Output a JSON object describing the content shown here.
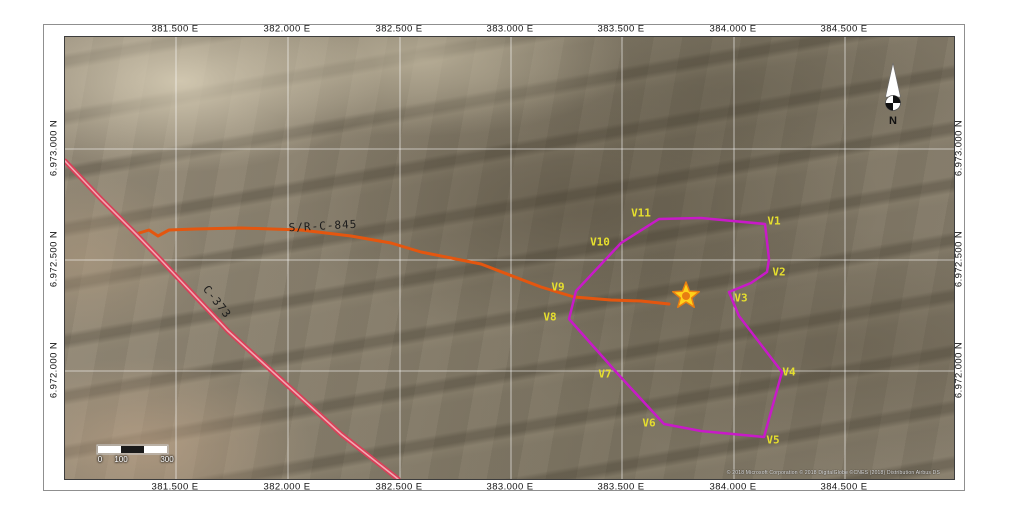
{
  "axis": {
    "top": [
      {
        "text": "381.500 E",
        "x": 175
      },
      {
        "text": "382.000 E",
        "x": 287
      },
      {
        "text": "382.500 E",
        "x": 399
      },
      {
        "text": "383.000 E",
        "x": 510
      },
      {
        "text": "383.500 E",
        "x": 621
      },
      {
        "text": "384.000 E",
        "x": 733
      },
      {
        "text": "384.500 E",
        "x": 844
      }
    ],
    "bottom": [
      {
        "text": "381.500 E",
        "x": 175
      },
      {
        "text": "382.000 E",
        "x": 287
      },
      {
        "text": "382.500 E",
        "x": 399
      },
      {
        "text": "383.000 E",
        "x": 510
      },
      {
        "text": "383.500 E",
        "x": 621
      },
      {
        "text": "384.000 E",
        "x": 733
      },
      {
        "text": "384.500 E",
        "x": 844
      }
    ],
    "left": [
      {
        "text": "6.973.000 N",
        "y": 148
      },
      {
        "text": "6.972.500 N",
        "y": 259
      },
      {
        "text": "6.972.000 N",
        "y": 370
      }
    ],
    "right": [
      {
        "text": "6.973.000 N",
        "y": 148
      },
      {
        "text": "6.972.500 N",
        "y": 259
      },
      {
        "text": "6.972.000 N",
        "y": 370
      }
    ]
  },
  "grid": {
    "vertical_x": [
      111,
      223,
      335,
      446,
      557,
      669,
      780
    ],
    "horizontal_y": [
      112,
      223,
      334
    ]
  },
  "roads": [
    {
      "name": "S/R-C-845",
      "color": "#e4560f",
      "width": 3,
      "points": [
        [
          71,
          197
        ],
        [
          84,
          193
        ],
        [
          93,
          199
        ],
        [
          104,
          193
        ],
        [
          130,
          192
        ],
        [
          176,
          191
        ],
        [
          236,
          193
        ],
        [
          286,
          199
        ],
        [
          326,
          206
        ],
        [
          356,
          215
        ],
        [
          416,
          227
        ],
        [
          476,
          250
        ],
        [
          509,
          260
        ],
        [
          546,
          263
        ],
        [
          576,
          264
        ],
        [
          604,
          267
        ]
      ],
      "label": {
        "text": "S/R-C-845",
        "x": 258,
        "y": 189,
        "rotate": -3
      }
    },
    {
      "name": "C-373",
      "color": "#d84058",
      "inner": "#f2a8b2",
      "width": 5,
      "points": [
        [
          0,
          124
        ],
        [
          36,
          162
        ],
        [
          71,
          197
        ],
        [
          96,
          223
        ],
        [
          163,
          294
        ],
        [
          221,
          347
        ],
        [
          276,
          397
        ],
        [
          333,
          442
        ]
      ],
      "label": {
        "text": "C-373",
        "x": 152,
        "y": 265,
        "rotate": 52
      }
    }
  ],
  "boundary": {
    "color": "#c81ac8",
    "width": 2.5,
    "label_color": "#e6df2e",
    "path": [
      [
        700,
        187
      ],
      [
        704,
        222
      ],
      [
        702,
        235
      ],
      [
        686,
        246
      ],
      [
        664,
        255
      ],
      [
        674,
        279
      ],
      [
        717,
        335
      ],
      [
        699,
        400
      ],
      [
        636,
        394
      ],
      [
        599,
        387
      ],
      [
        552,
        336
      ],
      [
        504,
        282
      ],
      [
        511,
        254
      ],
      [
        556,
        206
      ],
      [
        594,
        182
      ],
      [
        636,
        181
      ]
    ],
    "vertex_labels": [
      {
        "id": "V1",
        "x": 709,
        "y": 184
      },
      {
        "id": "V2",
        "x": 714,
        "y": 235
      },
      {
        "id": "V3",
        "x": 676,
        "y": 261
      },
      {
        "id": "V4",
        "x": 724,
        "y": 335
      },
      {
        "id": "V5",
        "x": 708,
        "y": 403
      },
      {
        "id": "V6",
        "x": 584,
        "y": 386
      },
      {
        "id": "V7",
        "x": 540,
        "y": 337
      },
      {
        "id": "V8",
        "x": 485,
        "y": 280
      },
      {
        "id": "V9",
        "x": 493,
        "y": 250
      },
      {
        "id": "V10",
        "x": 535,
        "y": 205
      },
      {
        "id": "V11",
        "x": 576,
        "y": 176
      }
    ]
  },
  "star": {
    "x": 621,
    "y": 259,
    "outer_r": 14,
    "inner_r": 6,
    "fill": "#ffd11a",
    "stroke": "#e87d12",
    "center_fill": "#e87d12",
    "center_r": 4
  },
  "scalebar": {
    "x": 33,
    "y": 409,
    "segment_w": 23,
    "h": 7,
    "colors": [
      "#ffffff",
      "#1a1a1a",
      "#ffffff"
    ],
    "labels": [
      {
        "text": "0",
        "x": 35
      },
      {
        "text": "100",
        "x": 56
      },
      {
        "text": "300",
        "x": 102
      }
    ],
    "label_y": 418
  },
  "north": {
    "label": "N"
  },
  "copyright": {
    "text": "© 2018 Microsoft Corporation © 2018 DigitalGlobe ©CNES (2018) Distribution Airbus DS"
  }
}
